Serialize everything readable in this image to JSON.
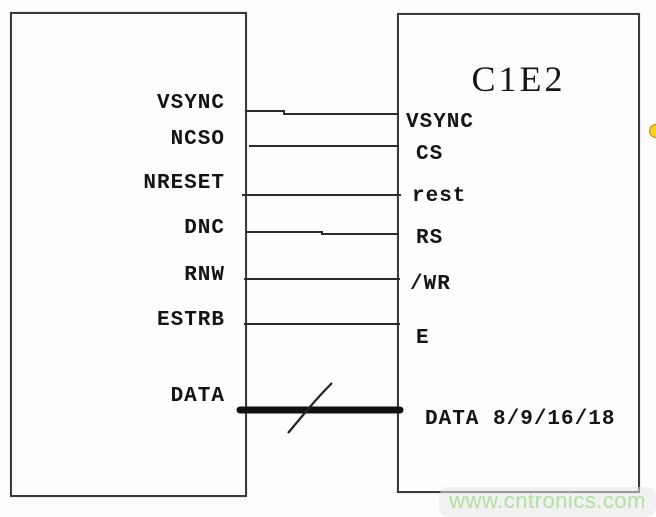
{
  "diagram": {
    "type": "circuit-block-diagram",
    "left_block": {
      "title": "",
      "pins": [
        {
          "label": "VSYNC"
        },
        {
          "label": "NCSO"
        },
        {
          "label": "NRESET"
        },
        {
          "label": "DNC"
        },
        {
          "label": "RNW"
        },
        {
          "label": "ESTRB"
        },
        {
          "label": "DATA"
        }
      ]
    },
    "right_block": {
      "title": "C1E2",
      "pins": [
        {
          "label": "VSYNC"
        },
        {
          "label": "CS"
        },
        {
          "label": "rest"
        },
        {
          "label": "RS"
        },
        {
          "label": "/WR"
        },
        {
          "label": "E"
        },
        {
          "label": "DATA 8/9/16/18"
        }
      ]
    },
    "connections": [
      {
        "from": "VSYNC",
        "to": "VSYNC",
        "type": "wire"
      },
      {
        "from": "NCSO",
        "to": "CS",
        "type": "wire"
      },
      {
        "from": "NRESET",
        "to": "rest",
        "type": "wire"
      },
      {
        "from": "DNC",
        "to": "RS",
        "type": "wire"
      },
      {
        "from": "RNW",
        "to": "/WR",
        "type": "wire"
      },
      {
        "from": "ESTRB",
        "to": "E",
        "type": "wire"
      },
      {
        "from": "DATA",
        "to": "DATA 8/9/16/18",
        "type": "bus",
        "bus_mark": "slash"
      }
    ],
    "colors": {
      "line": "#2b2b2b",
      "border": "#3a3a3a",
      "text": "#141414",
      "background": "#fdfdfd",
      "marker_dot": "#ffd41c",
      "watermark": "#b2e0a5"
    },
    "watermark": {
      "text": "www.cntronics.com"
    }
  }
}
